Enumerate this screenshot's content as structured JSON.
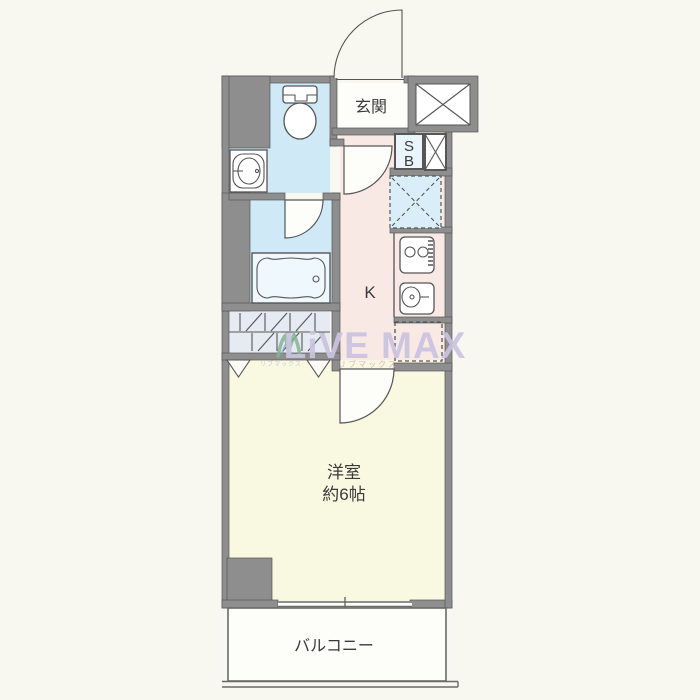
{
  "floorplan": {
    "labels": {
      "entrance": "玄関",
      "kitchen": "K",
      "room": "洋室",
      "room_size": "約6帖",
      "balcony": "バルコニー",
      "sb_top": "S",
      "sb_bottom": "B"
    },
    "watermark": {
      "brand": "LiVE MAX",
      "brand_kana": "リブマックス",
      "logo_kana": "リブマックス"
    },
    "colors": {
      "background": "#f8f7f0",
      "wall": "#8e8e8e",
      "wall_edge": "#565656",
      "line": "#555555",
      "water_blue": "#cfeaf6",
      "shaft_blue": "#d9eef8",
      "kitchen_pink": "#f9e9e4",
      "room_yellow": "#f9f9e2",
      "white_floor": "#fdfdfa",
      "closet_fill": "#e6eaf3",
      "watermark_purple": "#cbc4e0",
      "watermark_pink": "#dfb0cd",
      "watermark_green": "#83b493",
      "watermark_blue": "#7aa0c4",
      "text": "#3a3a3a"
    }
  }
}
